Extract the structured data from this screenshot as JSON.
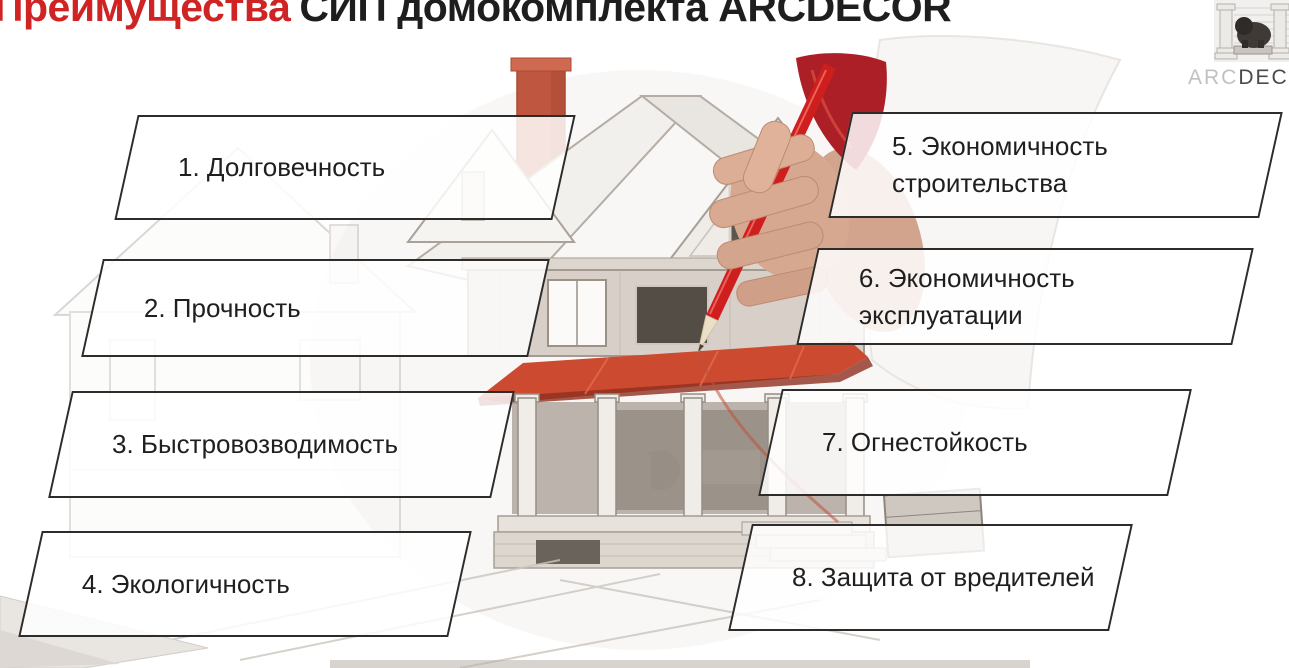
{
  "slide": {
    "title": {
      "highlight": "Преимущества",
      "rest": "СИП домокомплекта ARCDECOR"
    }
  },
  "logo": {
    "arc": "ARC",
    "decor": "DECOR"
  },
  "advantages": [
    {
      "label": "1. Долговечность"
    },
    {
      "label": "2. Прочность"
    },
    {
      "label": "3. Быстровозводимость"
    },
    {
      "label": "4. Экологичность"
    },
    {
      "label": "5. Экономичность строительства"
    },
    {
      "label": "6. Экономичность эксплуатации"
    },
    {
      "label": "7. Огнестойкость"
    },
    {
      "label": "8. Защита от вредителей"
    }
  ],
  "illustration": {
    "alt": "Рука с красным карандашом над эскизом дома"
  },
  "colors": {
    "title_red": "#d02323",
    "text_dark": "#1e1e1e",
    "box_border": "#2e2c2a",
    "roof_red": "#cc4a30",
    "chimney_red": "#bf5740",
    "pencil_red": "#ce1e1e",
    "sleeve_red": "#ad1f26"
  }
}
